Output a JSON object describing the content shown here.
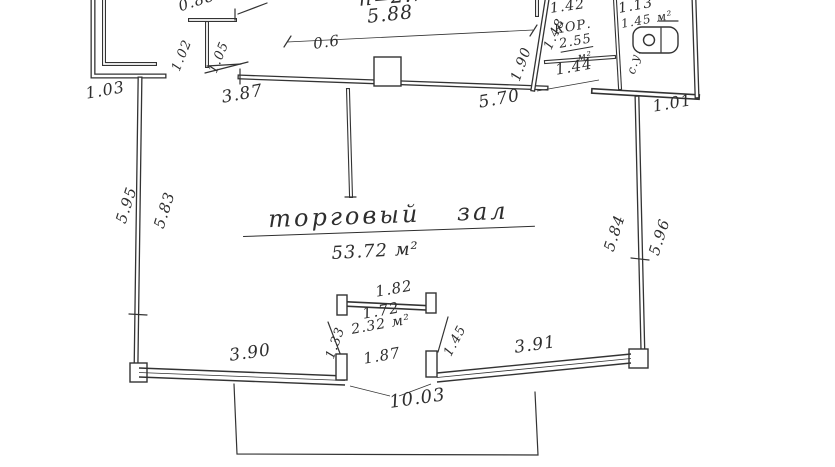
{
  "plan": {
    "paper_color": "#ffffff",
    "ink_color": "#2e2e2e",
    "rooms": {
      "hall": {
        "name": "торговый зал",
        "area": "53.72 м²"
      },
      "corridor": {
        "name": "КОР.",
        "area": "2.55",
        "area_unit": "м²"
      },
      "wc": {
        "area": "1.45 м²",
        "side_label": "с.у."
      }
    },
    "labels": {
      "height_note": "h=2.75",
      "top_width": "5.88",
      "col_width": "0.6",
      "niche_width": "0.88",
      "niche_depth_out": "1.02",
      "niche_depth_in": "1.05",
      "left_jog": "1.03",
      "wall_387": "3.87",
      "wall_570": "5.70",
      "corridor_height": "1.90",
      "slant_148": "1.48",
      "corr_width": "1.42",
      "corr_door": "1.44",
      "wc_width": "1.13",
      "right_jog": "1.01",
      "left_wall_out": "5.95",
      "left_wall_in": "5.83",
      "right_wall_in": "5.84",
      "right_wall_out": "5.96",
      "vest_top": "1.82",
      "vest_mid": "1.72",
      "vest_area": "2.32 м²",
      "vest_door": "1.87",
      "vest_left": "1.33",
      "vest_right": "1.45",
      "bottom_left": "3.90",
      "bottom_right": "3.91",
      "porch_width": "10.03"
    }
  }
}
